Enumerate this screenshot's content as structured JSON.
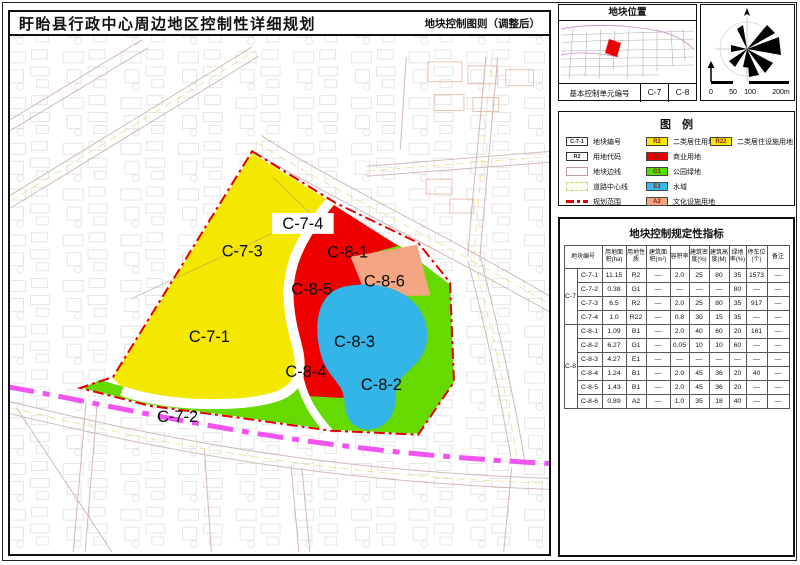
{
  "header": {
    "title": "盱眙县行政中心周边地区控制性详细规划",
    "subtitle": "地块控制图则（调整后）"
  },
  "location": {
    "title": "地块位置",
    "unit_label": "基本控制单元编号",
    "unit_codes": [
      "C-7",
      "C-8"
    ]
  },
  "compass": {
    "scale_labels": [
      "0",
      "50",
      "100",
      "200m"
    ]
  },
  "legend": {
    "title": "图　例",
    "symbols": [
      {
        "code": "C-7-1",
        "label": "地块编号",
        "type": "code"
      },
      {
        "code": "R2",
        "label": "用地代码",
        "type": "code"
      },
      {
        "code": "",
        "label": "地块边线",
        "type": "bound"
      },
      {
        "code": "",
        "label": "道路中心线",
        "type": "center"
      },
      {
        "code": "",
        "label": "规划范围",
        "type": "reddash"
      }
    ],
    "landuse": [
      {
        "code": "R2",
        "label": "二类居住用地",
        "color": "#f5e800"
      },
      {
        "code": "B1",
        "label": "商业用地",
        "color": "#ee0000"
      },
      {
        "code": "G1",
        "label": "公园绿地",
        "color": "#55dd00"
      },
      {
        "code": "E1",
        "label": "水域",
        "color": "#33bbee"
      },
      {
        "code": "A2",
        "label": "文化设施用地",
        "color": "#f4a582"
      }
    ],
    "landuse_right": [
      {
        "code": "R22",
        "label": "二类居住设施用地",
        "color": "#f5e800"
      }
    ]
  },
  "table": {
    "title": "地块控制规定性指标",
    "col_headers": [
      "地块编号",
      "用地面积(ha)",
      "用地性质",
      "建筑面积(m²)",
      "容积率",
      "建筑密度(%)",
      "建筑高度(M)",
      "绿地率(%)",
      "停车位(个)",
      "备注"
    ],
    "groups": [
      {
        "name": "C-7",
        "rows": [
          [
            "C-7-1",
            "11.15",
            "R2",
            "—",
            "2.0",
            "25",
            "80",
            "35",
            "1573",
            "—"
          ],
          [
            "C-7-2",
            "0.38",
            "G1",
            "—",
            "—",
            "—",
            "—",
            "80",
            "—",
            "—"
          ],
          [
            "C-7-3",
            "6.5",
            "R2",
            "—",
            "2.0",
            "25",
            "80",
            "35",
            "917",
            "—"
          ],
          [
            "C-7-4",
            "1.0",
            "R22",
            "—",
            "0.8",
            "30",
            "15",
            "35",
            "—",
            "—"
          ]
        ]
      },
      {
        "name": "C-8",
        "rows": [
          [
            "C-8-1",
            "1.09",
            "B1",
            "—",
            "2.0",
            "40",
            "60",
            "20",
            "161",
            "—"
          ],
          [
            "C-8-2",
            "6.27",
            "G1",
            "—",
            "0.05",
            "10",
            "10",
            "60",
            "—",
            "—"
          ],
          [
            "C-8-3",
            "4.27",
            "E1",
            "—",
            "—",
            "—",
            "—",
            "—",
            "—",
            "—"
          ],
          [
            "C-8-4",
            "1.24",
            "B1",
            "—",
            "2.0",
            "45",
            "36",
            "20",
            "40",
            "—"
          ],
          [
            "C-8-5",
            "1.43",
            "B1",
            "—",
            "2.0",
            "45",
            "36",
            "20",
            "—",
            "—"
          ],
          [
            "C-8-6",
            "0.89",
            "A2",
            "—",
            "1.0",
            "35",
            "18",
            "40",
            "—",
            "—"
          ]
        ]
      }
    ]
  },
  "map": {
    "zones": [
      {
        "label": "C-7-1"
      },
      {
        "label": "C-7-2"
      },
      {
        "label": "C-7-3"
      },
      {
        "label": "C-7-4"
      },
      {
        "label": "C-8-1"
      },
      {
        "label": "C-8-2"
      },
      {
        "label": "C-8-3"
      },
      {
        "label": "C-8-4"
      },
      {
        "label": "C-8-5"
      },
      {
        "label": "C-8-6"
      }
    ],
    "colors": {
      "residential": "#f5e800",
      "commercial": "#ee0000",
      "park": "#66d900",
      "water": "#33b5e8",
      "culture": "#f4a582",
      "plan_boundary": "#e00000",
      "planned_road": "#f055f0"
    }
  }
}
